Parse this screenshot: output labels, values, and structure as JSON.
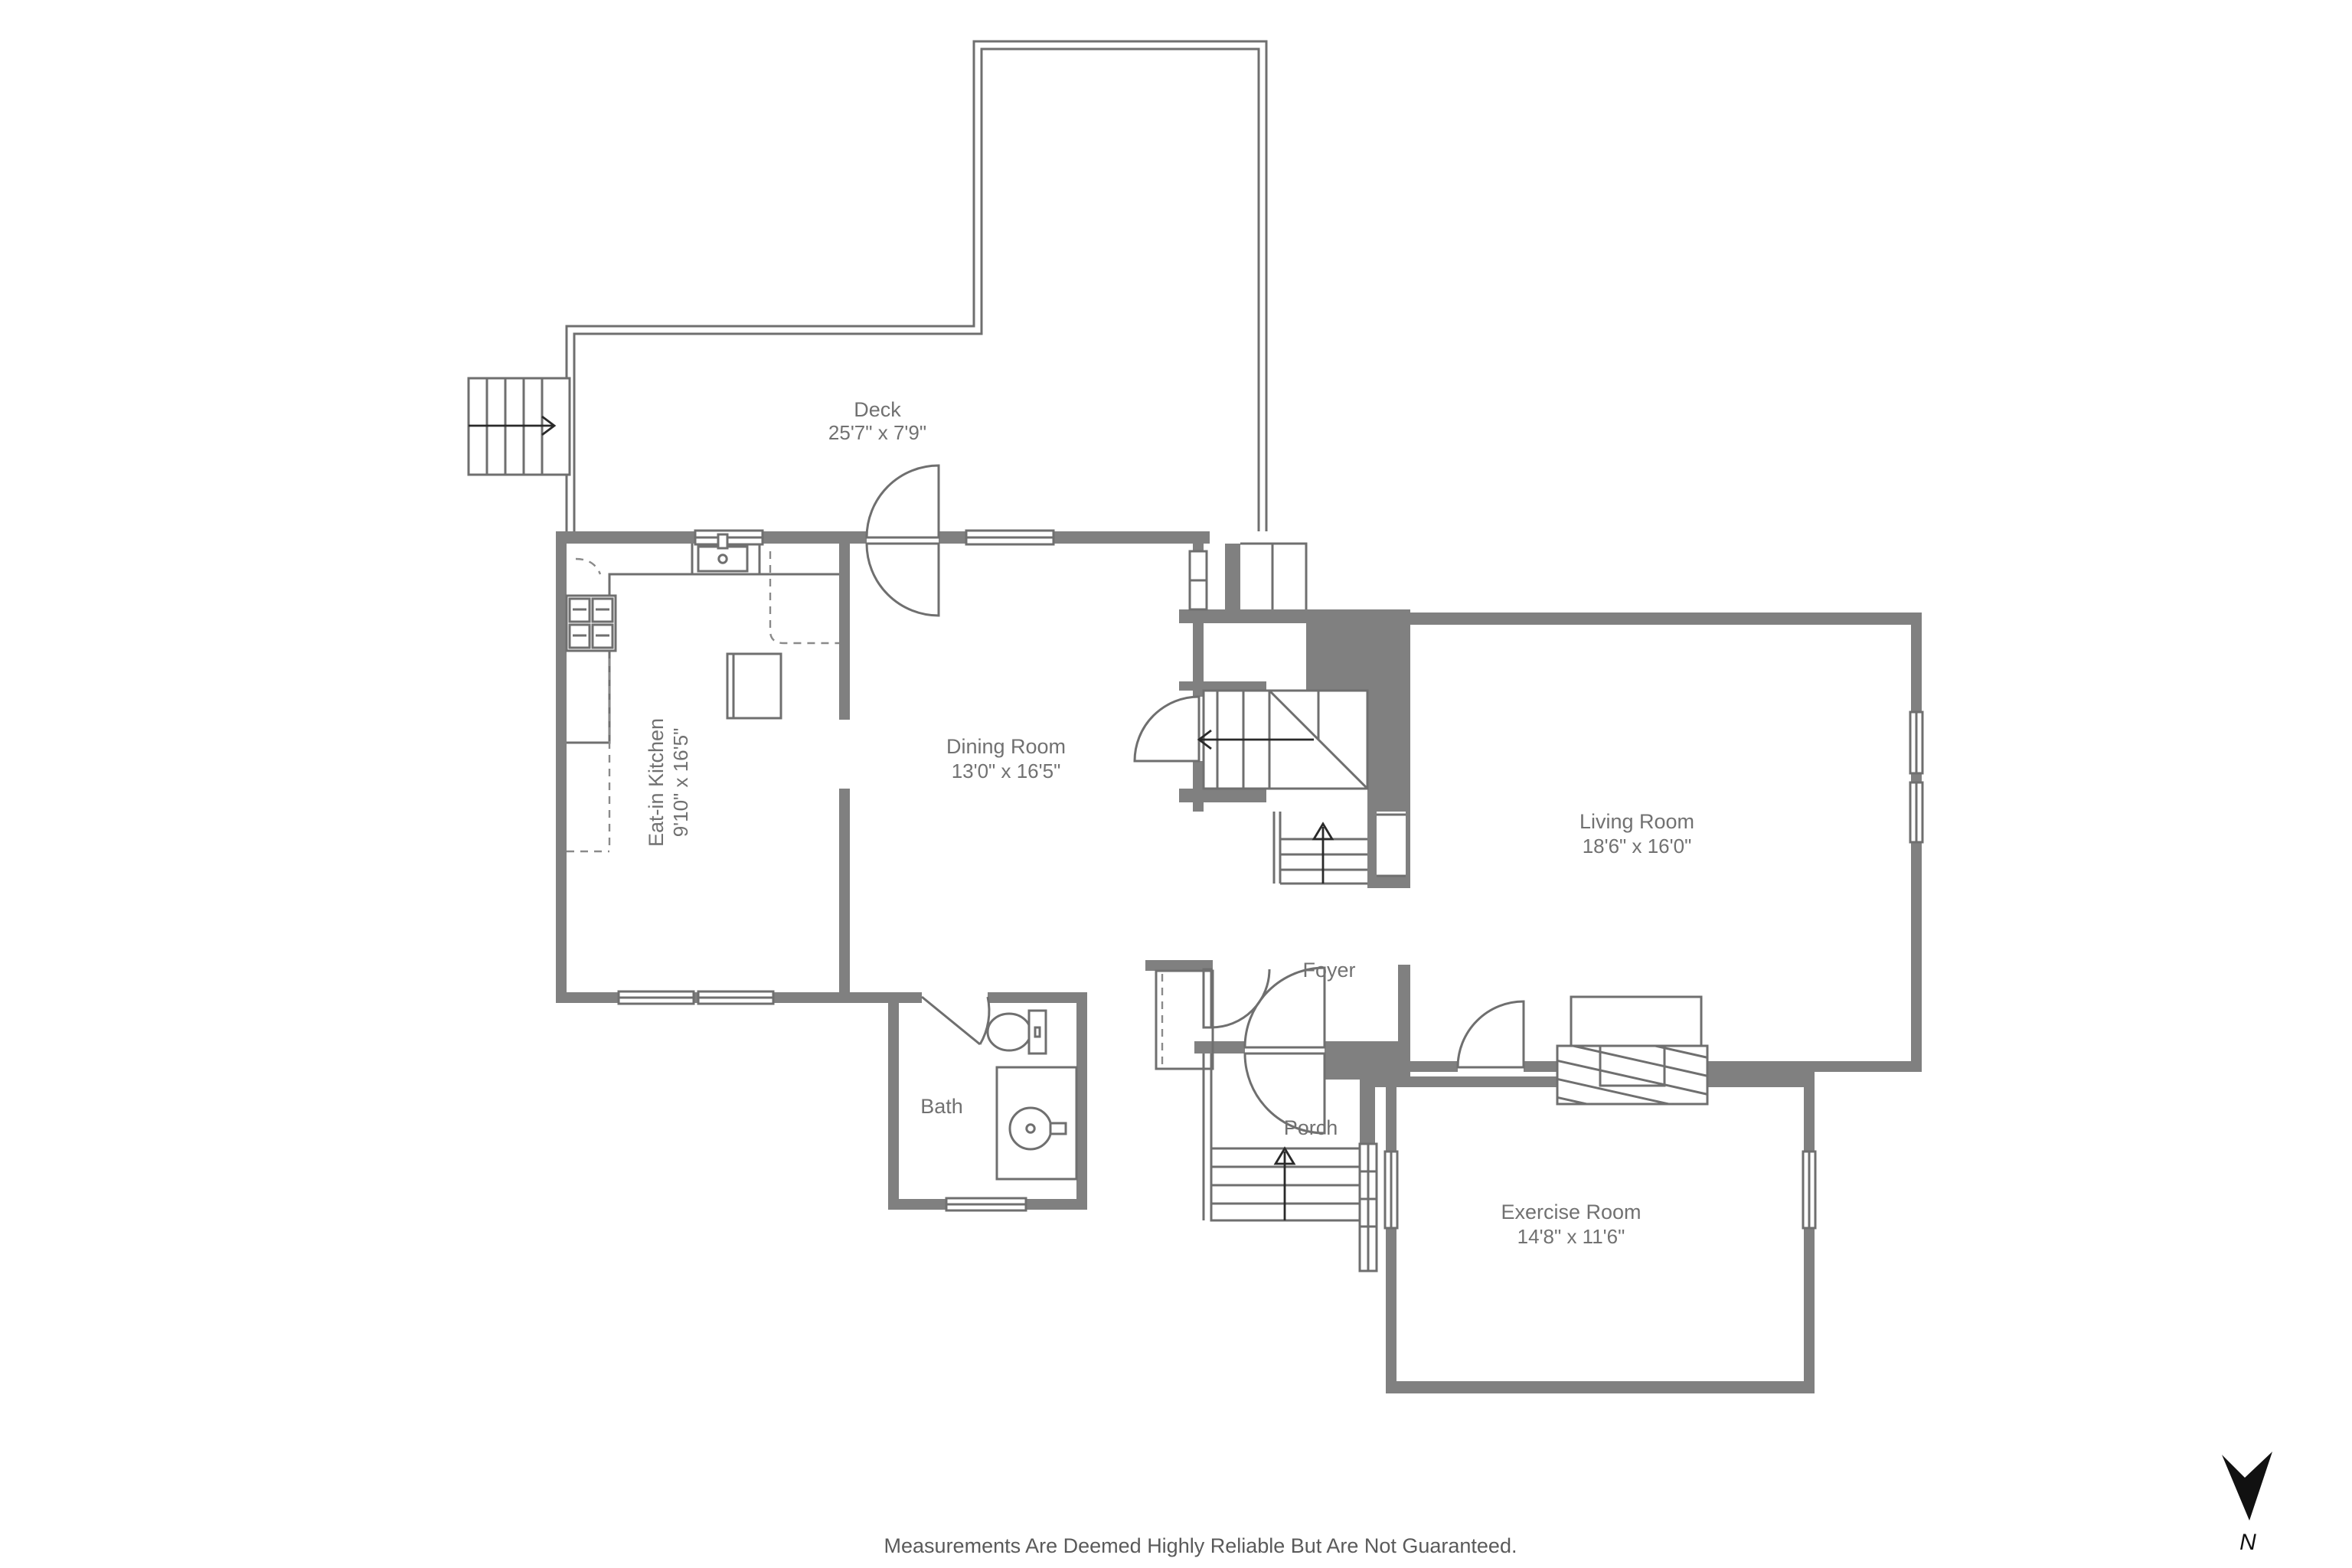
{
  "plan": {
    "rooms": {
      "deck": {
        "name": "Deck",
        "dims": "25'7\" x 7'9\""
      },
      "kitchen": {
        "name": "Eat-in Kitchen",
        "dims": "9'10\" x 16'5\""
      },
      "dining": {
        "name": "Dining Room",
        "dims": "13'0\" x 16'5\""
      },
      "living": {
        "name": "Living Room",
        "dims": "18'6\" x 16'0\""
      },
      "foyer": {
        "name": "Foyer"
      },
      "bath": {
        "name": "Bath"
      },
      "porch": {
        "name": "Porch"
      },
      "exercise": {
        "name": "Exercise Room",
        "dims": "14'8\" x 11'6\""
      }
    },
    "footer": {
      "disclaimer": "Measurements Are Deemed Highly Reliable But Are Not Guaranteed."
    },
    "watermark": "© SmartMLS, Inc.  2025",
    "compass": {
      "label": "N"
    },
    "colors": {
      "wall": "#808080",
      "line": "#6f6f6f",
      "label": "#717171",
      "disclaimer": "#5a5a5a",
      "watermark": "#b5b5b5",
      "north_arrow": "#111111"
    }
  }
}
